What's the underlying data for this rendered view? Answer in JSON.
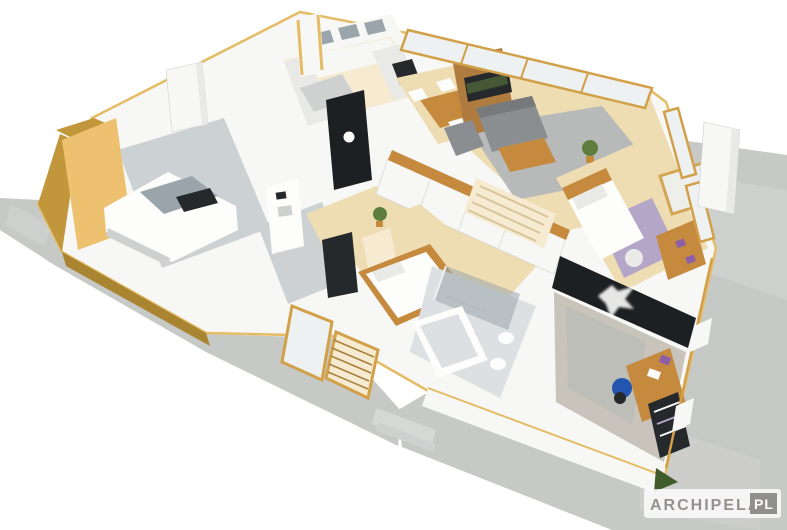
{
  "watermark": {
    "brand": "ARCHIPELAG",
    "suffix": "PL"
  },
  "scene": {
    "type": "isometric-house-cutaway-render",
    "rooms": [
      "garage",
      "utility-room",
      "kitchen",
      "dining-area",
      "living-room",
      "hallway-wardrobe",
      "pantry-wc",
      "master-bedroom",
      "bathroom",
      "kid-bedroom",
      "office-bedroom",
      "entry-porch",
      "terrace",
      "driveway"
    ]
  },
  "colors": {
    "background": "#ffffff",
    "concrete": "#c7c9c6",
    "concrete_light": "#d6d8d5",
    "wall_white": "#f7f7f5",
    "wall_shade": "#e9eae8",
    "wall_dark": "#cfd1d0",
    "cut_edge_yellow": "#e4bc66",
    "frame_wood": "#d2a049",
    "exterior_mustard": "#c2973b",
    "exterior_mustard_dark": "#a98431",
    "amber_wall": "#eec170",
    "glass_pane": "#eef1f2",
    "glass_dark": "#9aa5ab",
    "floor_wood": "#eedcb2",
    "floor_wood_light": "#f6ead0",
    "floor_tile": "#ccd1d3",
    "bath_tile": "#dce0e3",
    "rug_gray": "#b7bab8",
    "carpet_gray": "#c8c3bb",
    "lavender_rug": "#b3a6c6",
    "sofa_gray": "#8b8e90",
    "sofa_gray_dark": "#77797b",
    "furniture_wood": "#c68a3f",
    "tv_wall_brown": "#b07b3e",
    "accent_black": "#1d2023",
    "tv_screen": "#26292c",
    "pure_white": "#fdfdfc",
    "plant_green": "#5f7d3c",
    "bush_dark_green": "#3f5c2a",
    "purple_accent": "#8d5fa8",
    "chair_blue": "#2456b0",
    "watermark_band": "rgba(255,255,255,0.80)",
    "watermark_text": "#95918c",
    "watermark_box": "#908f8d"
  }
}
